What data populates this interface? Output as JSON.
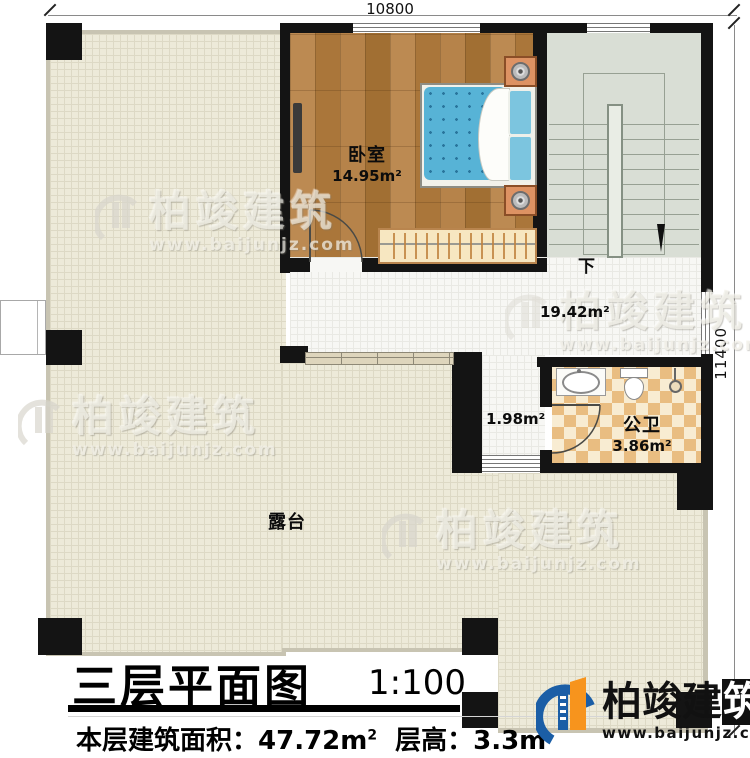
{
  "dimensions": {
    "top": "10800",
    "right": "11400"
  },
  "rooms": {
    "bedroom": {
      "name": "卧室",
      "area": "14.95m²"
    },
    "bath": {
      "name": "公卫",
      "area": "3.86m²"
    },
    "terrace": {
      "name": "露台"
    },
    "hall": {
      "area": "19.42m²"
    },
    "nook": {
      "area": "1.98m²"
    },
    "stairs": {
      "down_label": "下"
    }
  },
  "titleblock": {
    "title": "三层平面图",
    "scale": "1:100",
    "area_label": "本层建筑面积：",
    "area_value": "47.72m",
    "area_sup": "2",
    "height_label": "层高：",
    "height_value": "3.3m"
  },
  "brand": {
    "name_prefix": "柏竣建",
    "name_last": "筑",
    "url": "www.baijunjz.com"
  },
  "watermark": {
    "brand": "柏竣建筑",
    "url": "www.baijunjz.com"
  },
  "icons": {
    "stair_direction_arrow": "▼"
  },
  "colors": {
    "wall": "#141414",
    "wood_floor": "#b3813f",
    "terrace_floor": "#edead9",
    "stair_floor": "#d9ded5",
    "bath_tile": "#e9bd81",
    "bed_blue": "#57b3d6",
    "logo_blue": "#1b5ea6",
    "logo_orange": "#f7941d"
  }
}
